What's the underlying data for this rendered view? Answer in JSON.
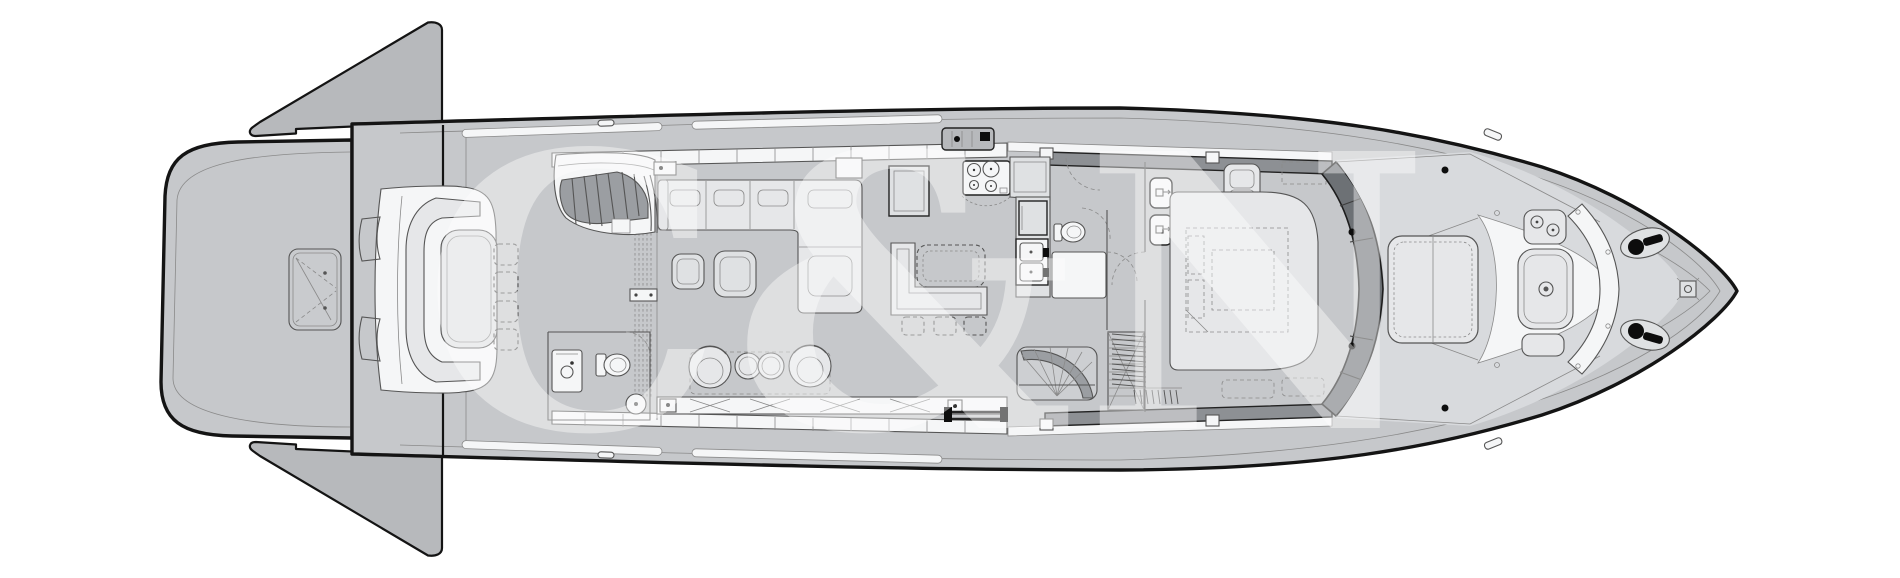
{
  "meta": {
    "title": "Yacht main deck general arrangement plan",
    "kind": "deck-plan-line-drawing",
    "orientation": "bow-right"
  },
  "watermark": {
    "text": "C&N"
  },
  "colors": {
    "background": "#ffffff",
    "hull": "#c6c8cb",
    "hull_dark": "#b7b9bc",
    "outline": "#141414",
    "line_medium": "#555555",
    "line_light": "#8a8a8a",
    "deck_panel": "#dfe1e3",
    "furniture": "#e6e7e9",
    "furniture_bright": "#f5f6f7",
    "glass_band": "#8d9094",
    "windshield": "#6d7175",
    "stair": "#9b9ea2",
    "black_fixture": "#0d0d0d",
    "watermark": "#ffffff"
  },
  "features": [
    {
      "id": "swim-platform",
      "label": "stern swim platform"
    },
    {
      "id": "tender-hatch",
      "label": "tender garage hatch"
    },
    {
      "id": "stern-wing-port",
      "label": "fold-out stern wing (port)"
    },
    {
      "id": "stern-wing-starboard",
      "label": "fold-out stern wing (starboard)"
    },
    {
      "id": "aft-cockpit",
      "label": "aft cockpit with C-sofa, table and four chairs"
    },
    {
      "id": "flybridge-stairs",
      "label": "stairs up to flybridge"
    },
    {
      "id": "sliding-door",
      "label": "salon sliding glass door"
    },
    {
      "id": "salon-sofa",
      "label": "salon L-sofa with cushions"
    },
    {
      "id": "coffee-tables",
      "label": "two salon coffee tables"
    },
    {
      "id": "swivel-chairs",
      "label": "two swivel armchairs and two poufs"
    },
    {
      "id": "sideboard",
      "label": "aft sideboard with cross-braced lockers"
    },
    {
      "id": "day-head",
      "label": "day head with vanity, WC and basin"
    },
    {
      "id": "galley",
      "label": "galley with cooktop, oven, double sink"
    },
    {
      "id": "dining",
      "label": "dining banquette with table and chairs"
    },
    {
      "id": "guest-head",
      "label": "guest WC"
    },
    {
      "id": "companionway",
      "label": "curved stairs down to lower deck"
    },
    {
      "id": "wardrobe",
      "label": "wardrobe with hangers"
    },
    {
      "id": "master-cabin",
      "label": "forward cabin with double bed, nightstands, vanity seat"
    },
    {
      "id": "windshield",
      "label": "curved windshield band"
    },
    {
      "id": "foredeck",
      "label": "foredeck with sun pad, table and curved seat"
    },
    {
      "id": "windlasses",
      "label": "twin anchor windlasses"
    },
    {
      "id": "bow-fitting",
      "label": "bow deck fitting"
    },
    {
      "id": "passerelle",
      "label": "side boarding passerelle"
    }
  ]
}
